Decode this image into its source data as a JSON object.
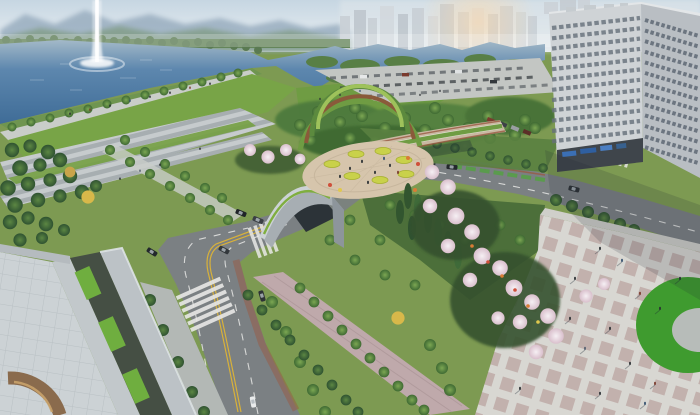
{
  "scene": {
    "description": "Aerial architectural rendering of a lakeside urban park: a tall single-jet fountain rises from a blue lake backed by hazy mountains and a distant apartment skyline; lakefront lawns and wide terrace steps lead to a central oval plaza with round yellow planters; an arched land-bridge tunnel carries the park over a curving tree-lined avenue with crosswalks and cars; swaths of white cherry blossoms and conifers border a large checkerboard pedestrian plaza with a kidney-shaped lawn; a concrete rooftop terrace with grass strips and a curved wooden deck sits in the near corner beside a tall white office building.",
    "features": [
      "lake",
      "fountain-jet",
      "mountain-ridge",
      "far-tree-line",
      "city-skyline",
      "sun-glow",
      "office-building",
      "lakefront-promenade",
      "lakefront-lawn",
      "terrace-steps",
      "tree-allee",
      "parking-lot",
      "park-forest",
      "oval-plaza",
      "yellow-planters",
      "arc-gardens",
      "tunnel-arch",
      "land-bridge",
      "bike-lane",
      "avenue",
      "crosswalks",
      "cars",
      "cherry-blossoms",
      "conifers",
      "pedestrian-plaza",
      "kidney-lawn",
      "rooftop-terrace",
      "grass-strips",
      "wooden-deck-arc",
      "street-trees",
      "people"
    ]
  },
  "palette": {
    "sky_top": "#cfdde6",
    "sky_haze": "#eef2f4",
    "mountain_far": "#9db1c2",
    "mountain_near": "#86a090",
    "water_far": "#9fb6c6",
    "water_deep": "#3f6c97",
    "far_trees": "#5a7a52",
    "lawn": "#78a447",
    "lawn_bright": "#6f9c43",
    "park_tree": "#4e7a3c",
    "conifer": "#2f5231",
    "blossom": "#eadfe7",
    "plaza_warm": "#d6c5ac",
    "plaza_base": "#d8d7d2",
    "plaza_square": "#bda8a4",
    "road": "#7b8083",
    "lane_yellow": "#d8b13a",
    "lane_white": "#e8e8e6",
    "bike_green": "#55a044",
    "median_red": "#9a5a44",
    "building_front": "#cfd3d6",
    "building_side": "#b9bec3",
    "window_dark": "#5f6a75",
    "sign_blue": "#3b6fb4",
    "concrete": "#c2c8cb",
    "courtyard": "#454f44",
    "grass_strip": "#6fae3f",
    "wood": "#8a6b4d",
    "planter_yellow": "#c9d14a",
    "flower_orange": "#d97c35",
    "kidney_green": "#3f9b2f",
    "autumn": "#d8b84a",
    "fountain_white": "#ffffff",
    "people_dark": "#2a2f33"
  }
}
